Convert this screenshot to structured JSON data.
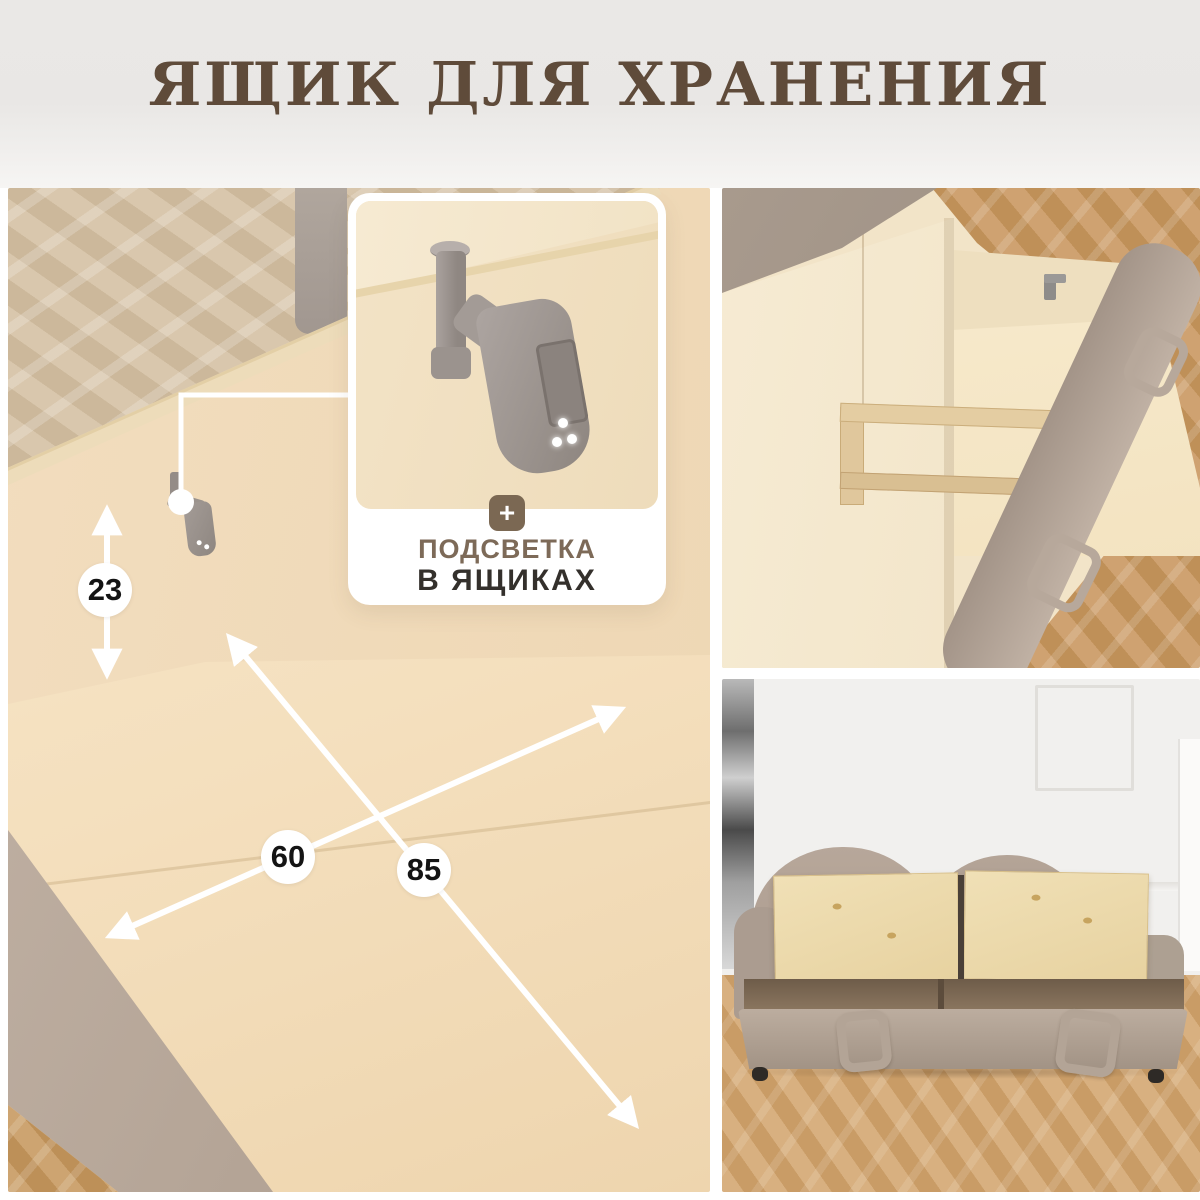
{
  "header": {
    "title": "ЯЩИК ДЛЯ ХРАНЕНИЯ"
  },
  "callout": {
    "plus_icon": "+",
    "line1": "ПОДСВЕТКА",
    "line2": "В ЯЩИКАХ"
  },
  "dimensions": {
    "height_cm": "23",
    "width_cm": "60",
    "depth_cm": "85"
  },
  "colors": {
    "title": "#5f4b3a",
    "callout_accent": "#7d6a58",
    "callout_dark": "#34302c",
    "badge": "#7b6853",
    "annotation": "#ffffff",
    "dimension_text": "#141414"
  }
}
